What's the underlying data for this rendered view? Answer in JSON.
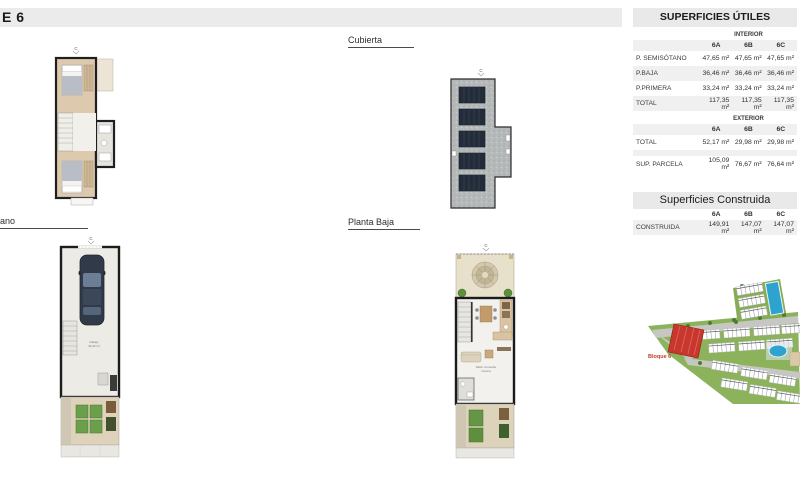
{
  "page": {
    "title": "E 6"
  },
  "labels": {
    "cubierta": "Cubierta",
    "semisotano": "ano",
    "planta_baja": "Planta Baja",
    "compass": "C"
  },
  "map": {
    "bloque_label": "Bloque 6"
  },
  "annotations": {
    "garage": "Garaje",
    "garage_area": "44,22 m²",
    "salon": "Salón Comedor",
    "cocina": "Cocina"
  },
  "tables": {
    "utiles": {
      "title": "SUPERFICIES ÚTILES",
      "interior": {
        "section": "INTERIOR",
        "columns": [
          "6A",
          "6B",
          "6C"
        ],
        "rows": [
          {
            "label": "P. SEMISÓTANO",
            "values": [
              "47,65 m²",
              "47,65 m²",
              "47,65 m²"
            ]
          },
          {
            "label": "P.BAJA",
            "values": [
              "36,46 m²",
              "36,46 m²",
              "36,46 m²"
            ]
          },
          {
            "label": "P.PRIMERA",
            "values": [
              "33,24 m²",
              "33,24 m²",
              "33,24 m²"
            ]
          },
          {
            "label": "TOTAL",
            "values": [
              "117,35 m²",
              "117,35 m²",
              "117,35 m²"
            ]
          }
        ]
      },
      "exterior": {
        "section": "EXTERIOR",
        "columns": [
          "6A",
          "6B",
          "6C"
        ],
        "rows": [
          {
            "label": "TOTAL",
            "values": [
              "52,17 m²",
              "29,98 m²",
              "29,98 m²"
            ]
          },
          {
            "label": "SUP. PARCELA",
            "values": [
              "105,09 m²",
              "76,67 m²",
              "76,64 m²"
            ]
          }
        ]
      }
    },
    "construida": {
      "title": "Superficies Construida",
      "columns": [
        "6A",
        "6B",
        "6C"
      ],
      "rows": [
        {
          "label": "CONSTRUIDA",
          "values": [
            "149,91 m²",
            "147,07 m²",
            "147,07 m²"
          ]
        }
      ]
    }
  },
  "colors": {
    "band_gray": "#e9e9e9",
    "stripe_gray": "#f0f0f0",
    "accent_red": "#c0392b",
    "pool_blue": "#2ea3cf",
    "grass_green": "#8cb25c"
  }
}
